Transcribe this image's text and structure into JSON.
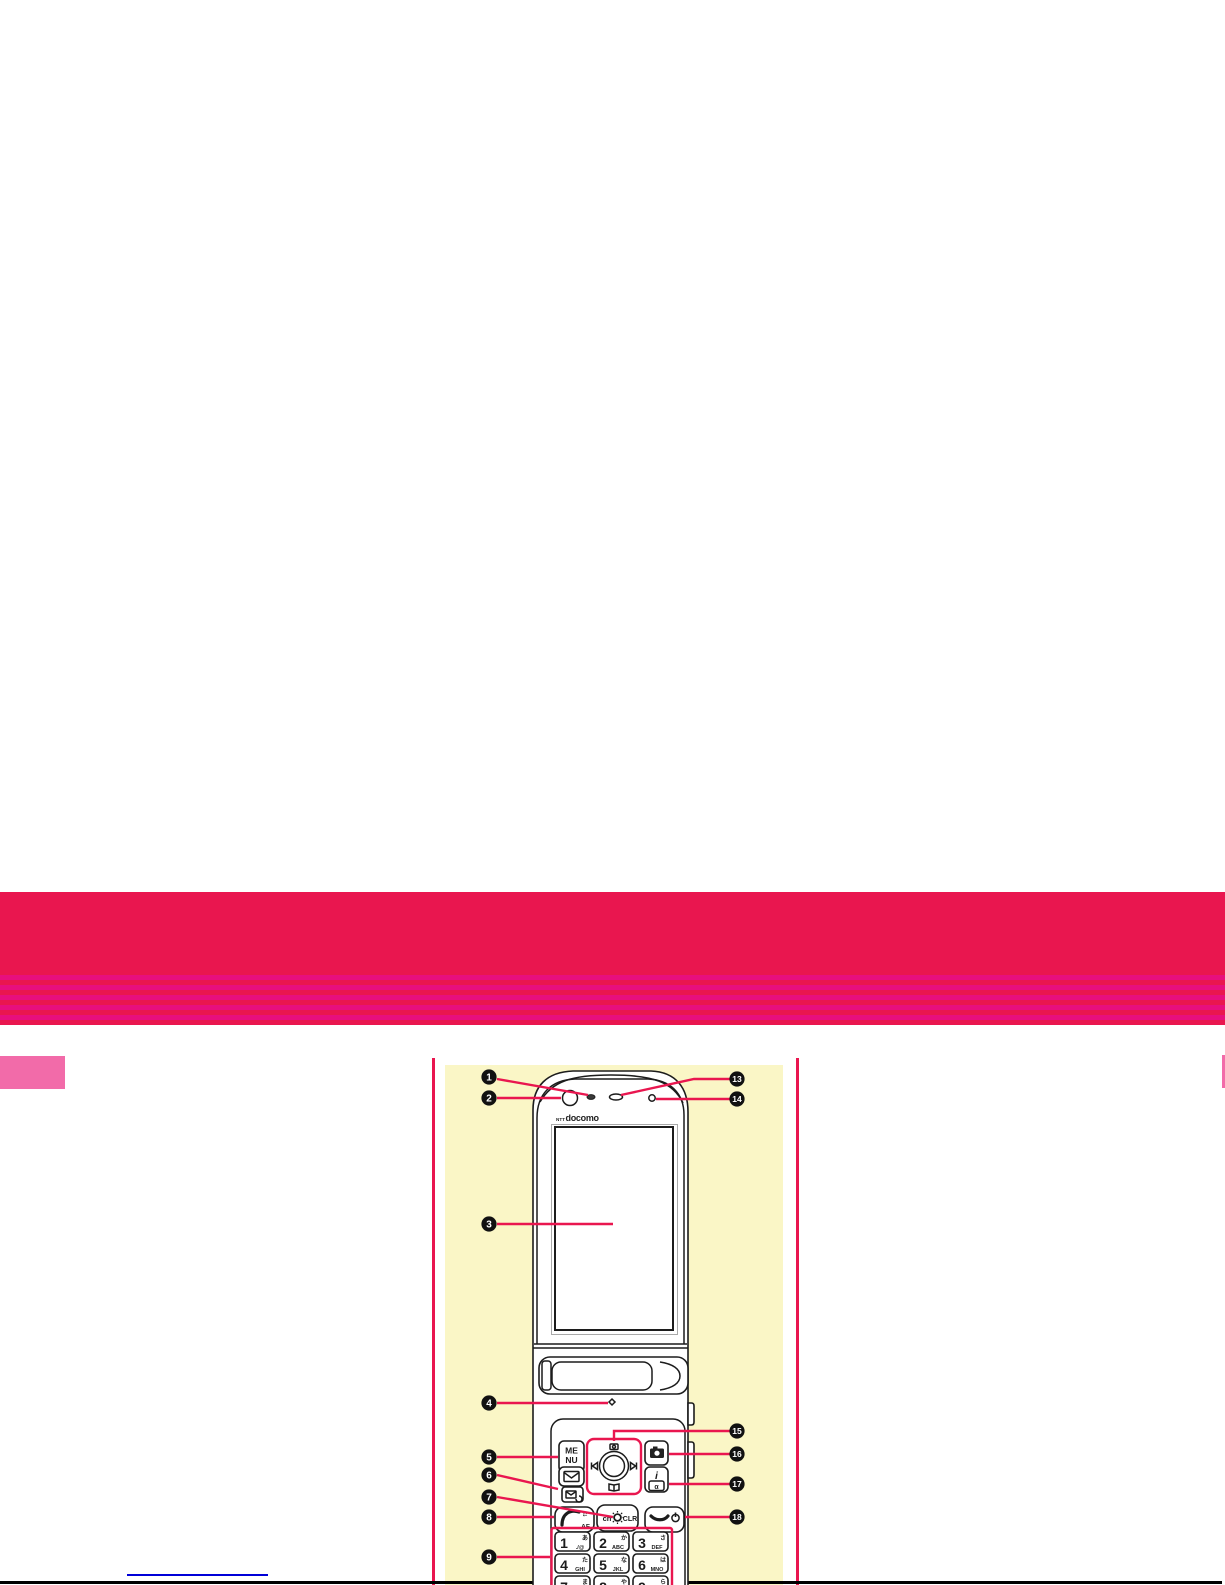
{
  "page": {
    "width": 1225,
    "height": 1585
  },
  "colors": {
    "crimson": "#e9164f",
    "magenta": "#e70f7d",
    "yellow": "#faf6c6",
    "pink": "#f26ba9",
    "blue": "#0000d8",
    "ink": "#1c1c1c"
  },
  "diagram": {
    "brand_prefix": "NTT",
    "brand_name": "docomo",
    "callouts": [
      {
        "number": "1"
      },
      {
        "number": "2"
      },
      {
        "number": "3"
      },
      {
        "number": "4"
      },
      {
        "number": "5"
      },
      {
        "number": "6"
      },
      {
        "number": "7"
      },
      {
        "number": "8"
      },
      {
        "number": "9"
      },
      {
        "number": "13"
      },
      {
        "number": "14"
      },
      {
        "number": "15"
      },
      {
        "number": "16"
      },
      {
        "number": "17"
      },
      {
        "number": "18"
      }
    ],
    "keys": {
      "menu_line1": "ME",
      "menu_line2": "NU",
      "ch_label": "ch",
      "clr_label": "CLR",
      "call_af_label": "AF",
      "call_arrows": "⇄",
      "imode_label": "i",
      "iappli_label": "α",
      "keypad": [
        {
          "digit": "1",
          "letters": "./@",
          "kana": "あ"
        },
        {
          "digit": "2",
          "letters": "ABC",
          "kana": "か"
        },
        {
          "digit": "3",
          "letters": "DEF",
          "kana": "さ"
        },
        {
          "digit": "4",
          "letters": "GHI",
          "kana": "た"
        },
        {
          "digit": "5",
          "letters": "JKL",
          "kana": "な"
        },
        {
          "digit": "6",
          "letters": "MNO",
          "kana": "は"
        },
        {
          "digit": "7",
          "letters": "PQRS",
          "kana": "ま"
        },
        {
          "digit": "8",
          "letters": "TUV",
          "kana": "や"
        },
        {
          "digit": "9",
          "letters": "WXYZ",
          "kana": "ら"
        }
      ]
    }
  }
}
